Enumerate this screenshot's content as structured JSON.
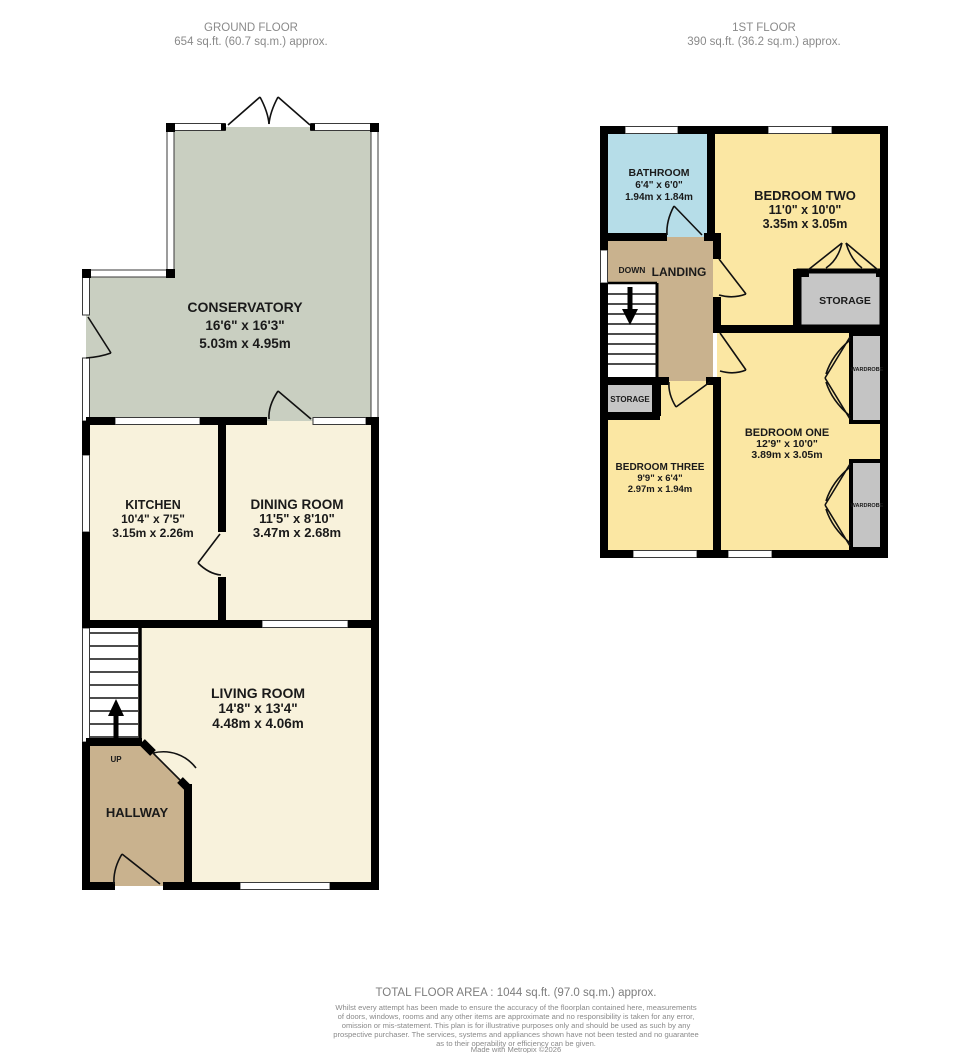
{
  "header": {
    "ground_floor": {
      "title": "GROUND FLOOR",
      "area": "654 sq.ft. (60.7 sq.m.) approx."
    },
    "first_floor": {
      "title": "1ST FLOOR",
      "area": "390 sq.ft. (36.2 sq.m.) approx."
    }
  },
  "ground_floor": {
    "rooms": {
      "conservatory": {
        "name": "CONSERVATORY",
        "imperial": "16'6\" x 16'3\"",
        "metric": "5.03m x 4.95m"
      },
      "kitchen": {
        "name": "KITCHEN",
        "imperial": "10'4\" x 7'5\"",
        "metric": "3.15m x 2.26m"
      },
      "dining_room": {
        "name": "DINING ROOM",
        "imperial": "11'5\" x 8'10\"",
        "metric": "3.47m x 2.68m"
      },
      "living_room": {
        "name": "LIVING ROOM",
        "imperial": "14'8\" x 13'4\"",
        "metric": "4.48m x 4.06m"
      },
      "hallway": {
        "name": "HALLWAY"
      }
    },
    "labels": {
      "up": "UP"
    }
  },
  "first_floor": {
    "rooms": {
      "bathroom": {
        "name": "BATHROOM",
        "imperial": "6'4\" x 6'0\"",
        "metric": "1.94m x 1.84m"
      },
      "bedroom_two": {
        "name": "BEDROOM TWO",
        "imperial": "11'0\" x 10'0\"",
        "metric": "3.35m x 3.05m"
      },
      "bedroom_one": {
        "name": "BEDROOM ONE",
        "imperial": "12'9\" x 10'0\"",
        "metric": "3.89m x 3.05m"
      },
      "bedroom_three": {
        "name": "BEDROOM THREE",
        "imperial": "9'9\" x 6'4\"",
        "metric": "2.97m x 1.94m"
      },
      "landing": {
        "name": "LANDING"
      },
      "storage_main": {
        "name": "STORAGE"
      },
      "storage_small": {
        "name": "STORAGE"
      },
      "wardrobe_top": {
        "name": "WARDROBE"
      },
      "wardrobe_bottom": {
        "name": "WARDROBE"
      }
    },
    "labels": {
      "down": "DOWN"
    }
  },
  "footer": {
    "total_area": "TOTAL FLOOR AREA : 1044 sq.ft. (97.0 sq.m.) approx.",
    "disclaimer_lines": [
      "Whilst every attempt has been made to ensure the accuracy of the floorplan contained here, measurements",
      "of doors, windows, rooms and any other items are approximate and no responsibility is taken for any error,",
      "omission or mis-statement. This plan is for illustrative purposes only and should be used as such by any",
      "prospective purchaser. The services, systems and appliances shown have not been tested and no guarantee",
      "as to their operability or efficiency can be given."
    ],
    "credit": "Made with Metropix ©2026"
  },
  "colors": {
    "wall": "#000000",
    "conservatory_fill": "#c9cfc1",
    "cream_fill": "#f8f2dc",
    "tan_fill": "#c9b28e",
    "bathroom_fill": "#b6dde8",
    "bedroom_fill": "#fbe7a3",
    "storage_fill": "#c6c6c6",
    "label_text": "#1a1a1a",
    "muted_text": "#8a8a8a"
  }
}
